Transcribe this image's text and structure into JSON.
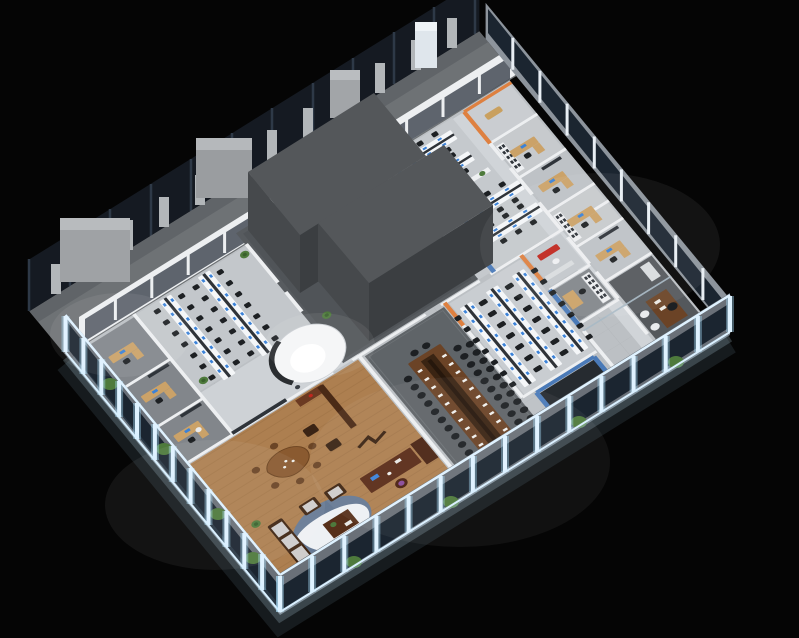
{
  "scene": {
    "title": "3D isometric office floor plan rendering",
    "style": "photorealistic axonometric render on black background"
  },
  "palette": {
    "bg": "#050505",
    "terr": "#6e7275",
    "terr_dark": "#606468",
    "glass": "#151a22",
    "glass_mullion": "#2e3947",
    "pillar": "#b2b6b9",
    "wallouter": "#6a7078",
    "wallfar": "#8d949c",
    "pane": "#1b2530",
    "frame": "#dff2ff",
    "glow": "#9fd4f5",
    "floor": "#bcc0c4",
    "corridor": "#d0d4d8",
    "wall": "#edeff1",
    "carpet": "#82868b",
    "confc": "#5f6468",
    "conft": "#6b4326",
    "wood": "#ad7f50",
    "woodln": "#8f6538",
    "furn": "#4a2a16",
    "desk_wood": "#cba268",
    "desk_white": "#f4f6f8",
    "desk_divider": "#2f3338",
    "chair": "#1d2023",
    "scr": "#3b82d8",
    "orange": "#de8040",
    "blue": "#4a7ab8",
    "plant": "#4e7a3c",
    "plant_dark": "#39602c",
    "shelf": "#eef0f2",
    "art": "#2f343a",
    "whiterug": "#eef1f4",
    "bluerug": "#5b79a0",
    "core_top": "#54575a",
    "core_left": "#46494c",
    "core_front": "#3b3e41",
    "core_plinth": "#575b5f",
    "red": "#c0271e",
    "white_chair": "#e9ebed",
    "tan": "#c9a05f"
  },
  "rooms": [
    {
      "name": "terrace",
      "note": "outdoor gray deck with pillars and dark curtain wall"
    },
    {
      "name": "open-office-left",
      "note": "2 workstation rows, white desks, blue monitors"
    },
    {
      "name": "reception-circle",
      "note": "white sculptural curved wall"
    },
    {
      "name": "executive-office",
      "note": "wood floor, tea table, desk, sofa set, screens"
    },
    {
      "name": "conference-room",
      "note": "long wood table, 22+ black chairs"
    },
    {
      "name": "training-room",
      "note": "3 desk rows with chairs"
    },
    {
      "name": "top-right-open-office",
      "note": "4 workstation rows with planters"
    },
    {
      "name": "private-office-row",
      "note": "small offices along right edge"
    },
    {
      "name": "orange-room",
      "note": "orange accent walls"
    },
    {
      "name": "blue-meeting-room",
      "note": "blue walls, dark floor"
    },
    {
      "name": "manager-office",
      "note": "dark carpet, wood desk, white guest chairs"
    },
    {
      "name": "core-blocks",
      "note": "two dark service core volumes"
    },
    {
      "name": "window-walls",
      "note": "glowing blue-white framed glazing with plants"
    }
  ],
  "counts": {
    "core_blocks": 2,
    "workstation_rows_visible": 12,
    "private_offices_right": 6,
    "conference_chairs_per_side": 11,
    "terrace_pillars": 12
  }
}
